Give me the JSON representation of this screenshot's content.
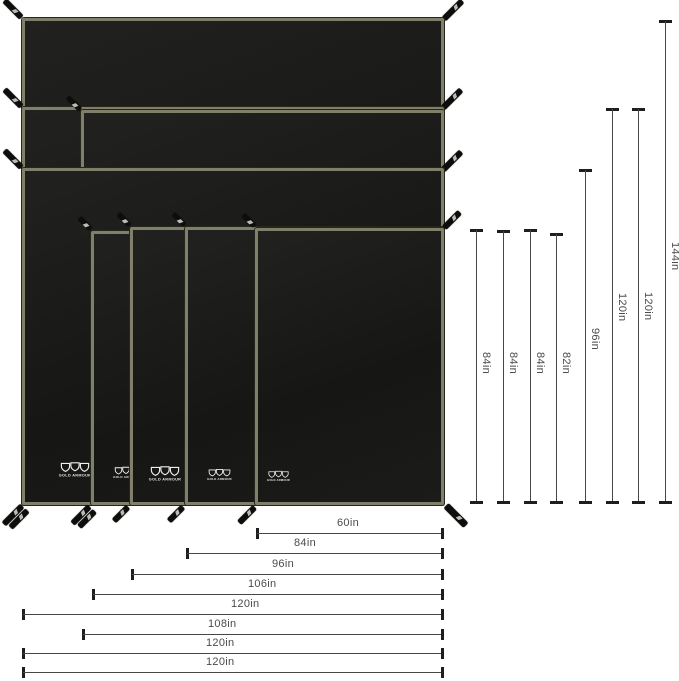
{
  "brand": "GOLD ARMOUR",
  "dims": {
    "vertical": [
      "84in",
      "84in",
      "84in",
      "82in",
      "96in",
      "120in",
      "120in",
      "144in"
    ],
    "horizontal": [
      "60in",
      "84in",
      "96in",
      "106in",
      "120in",
      "108in",
      "120in",
      "120in"
    ]
  },
  "tarp_sizes": [
    {
      "width": "60in",
      "height": "84in"
    },
    {
      "width": "84in",
      "height": "84in"
    },
    {
      "width": "96in",
      "height": "84in"
    },
    {
      "width": "106in",
      "height": "82in"
    },
    {
      "width": "120in",
      "height": "96in"
    },
    {
      "width": "108in",
      "height": "120in"
    },
    {
      "width": "120in",
      "height": "120in"
    },
    {
      "width": "120in",
      "height": "144in"
    }
  ],
  "colors": {
    "background": "#ffffff",
    "tarp_fill": "#1a1a18",
    "tarp_edge": "#80806a",
    "strap": "#0d0d0b",
    "dimension_line": "#474747",
    "dimension_tick": "#1e1e1e",
    "label_text": "#4b4b4b",
    "logo": "#f0f0ee"
  }
}
